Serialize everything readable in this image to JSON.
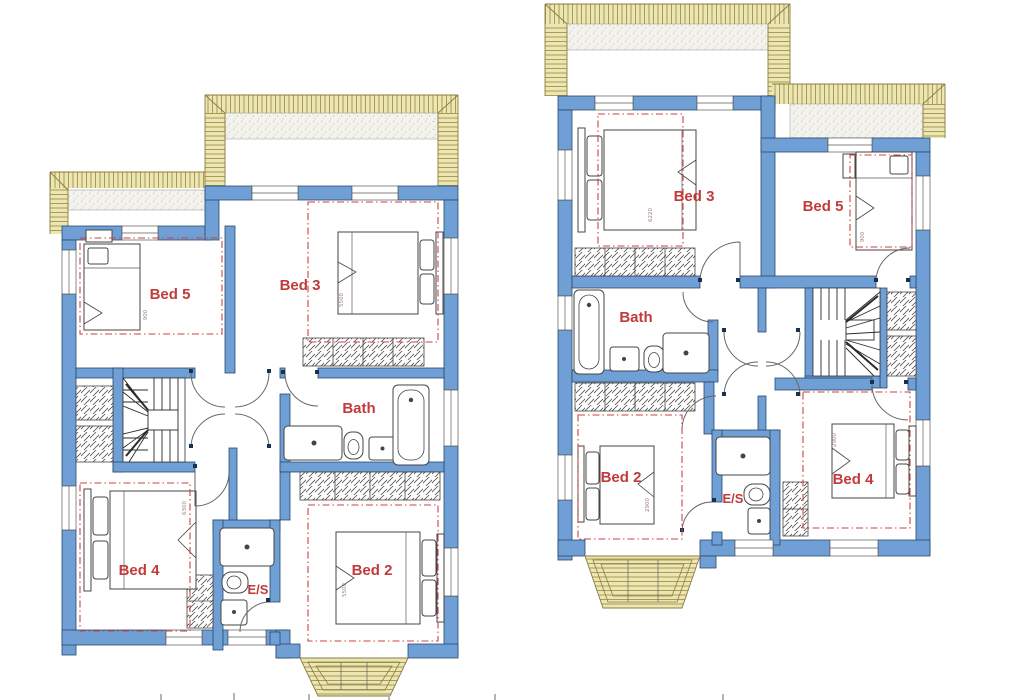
{
  "palette": {
    "wall_blue": "#6f9fd5",
    "wall_outline": "#29496b",
    "roof_hatch_yellow": "#ece5b4",
    "roof_hatch_line": "#a99c52",
    "room_label_red": "#c23a3a",
    "dashed_outline_red": "#cb4343",
    "furniture_line": "#444444"
  },
  "plans": {
    "left": {
      "name": "left-floor-plan",
      "labels": {
        "bed5": "Bed 5",
        "bed3": "Bed 3",
        "bath": "Bath",
        "bed4": "Bed 4",
        "bed2": "Bed 2",
        "ensuite": "E/S"
      },
      "dims": {
        "bed5": "900",
        "bed3": "5500",
        "bed4": "6300",
        "bed2": "5500"
      }
    },
    "right": {
      "name": "right-floor-plan",
      "labels": {
        "bed3": "Bed 3",
        "bed5": "Bed 5",
        "bath": "Bath",
        "bed2": "Bed 2",
        "ensuite": "E/S",
        "bed4": "Bed 4"
      },
      "dims": {
        "bed3": "6220",
        "bed5": "900",
        "bed2": "2900",
        "bed4": "2900"
      }
    }
  }
}
